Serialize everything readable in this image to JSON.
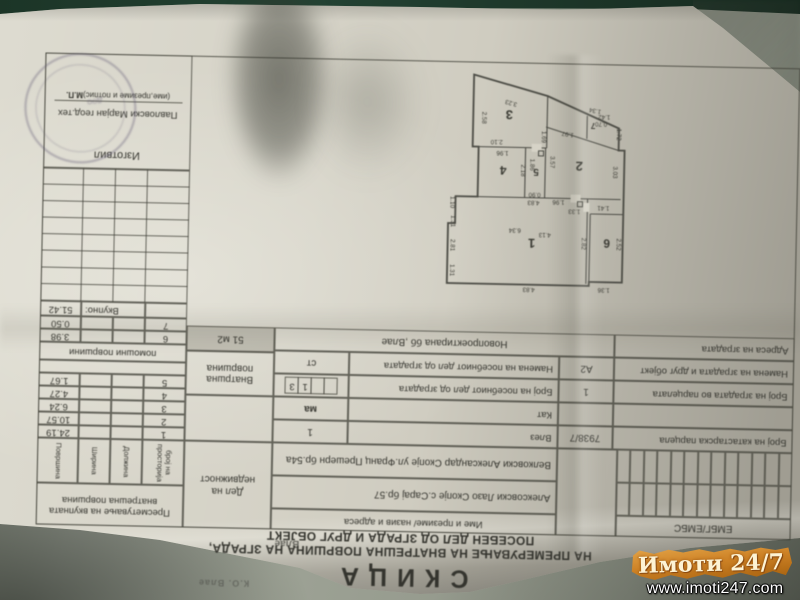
{
  "watermark": {
    "brand": "Имоти 24/7",
    "url": "www.imoti247.com"
  },
  "doc": {
    "title": "СКИЦА",
    "subtitle1": "НА ПРЕМЕРУВАЊЕ НА ВНАТРЕШНА ПОВРШИНА НА ЗГРАДА,",
    "subtitle2": "ПОСЕБЕН ДЕЛ ОД ЗГРАДА И ДРУГ ОБЈЕКТ",
    "ko_value": "Влае",
    "ko_note": "К.О. Влае",
    "embg_label": "ЕМБГ/ЕМБС",
    "names_header": "Име и презиме/ назив и адреса",
    "owner1": "Алексовски Лазо Скопје с.Сарај бр.57",
    "owner2": "Велковски Александар Скопје ул.Франц Прешерн бр.54а",
    "del_label": "Дел на недвижност",
    "inner_area_label": "Внатршна површина",
    "inner_area_value": "51 м2",
    "info": {
      "r1l": "Број на катастарска парцела",
      "r1lv": "7938/7",
      "r1r": "Влез",
      "r1rv": "1",
      "r2r": "Кат",
      "r2rv": "ма",
      "r3l": "Број  на зградата во парцелата",
      "r3lv": "1",
      "r3r": "Број на посебниот дел од зградата",
      "r3b3": "1",
      "r3b4": "3",
      "r4l": "Намена на зградата и друг објект",
      "r4lv": "А2",
      "r4r": "Намена на посебниот дел од зградата",
      "r4rv": "ст",
      "r5l": "Адреса на зградата",
      "r5v": "Новопроектирана бб ,Влае"
    },
    "calc": {
      "header": "Пресметување на вкупната внатрешна површина",
      "col1": "број на просторија",
      "col2": "Должина",
      "col3": "Ширина",
      "col4": "Површина",
      "rows": [
        [
          "1",
          "24.19"
        ],
        [
          "2",
          "10.57"
        ],
        [
          "3",
          "6.24"
        ],
        [
          "4",
          "4.27"
        ],
        [
          "5",
          "1.67"
        ]
      ],
      "aux_label": "помошни површини",
      "aux_rows": [
        [
          "6",
          "3.98"
        ],
        [
          "7",
          "0.50"
        ]
      ],
      "total_label": "Вкупно:",
      "total_value": "51.42"
    },
    "prepared": {
      "label": "Изготвил",
      "name": "Павловски Марјан геод.тех",
      "caption": "(име,презиме и потпис)",
      "mp": "М.П.",
      "stamp_text": "доо"
    },
    "plan": {
      "rooms": [
        "1",
        "2",
        "3",
        "4",
        "5",
        "6",
        "7"
      ],
      "dims": [
        "4.83",
        "1.31",
        "2.81",
        "1.31",
        "1.10",
        "6.34",
        "4.13",
        "4.83",
        "1.36",
        "2.52",
        "2.82",
        "1.41",
        "1.33",
        "1.96",
        "3.03",
        "3.57",
        "1.69",
        "1.97",
        "0.70",
        "1.42",
        "1.72",
        "1.34",
        "0.90",
        "1.86",
        "2.18",
        "1.96",
        "2.10",
        "3.23",
        "2.58"
      ]
    }
  }
}
